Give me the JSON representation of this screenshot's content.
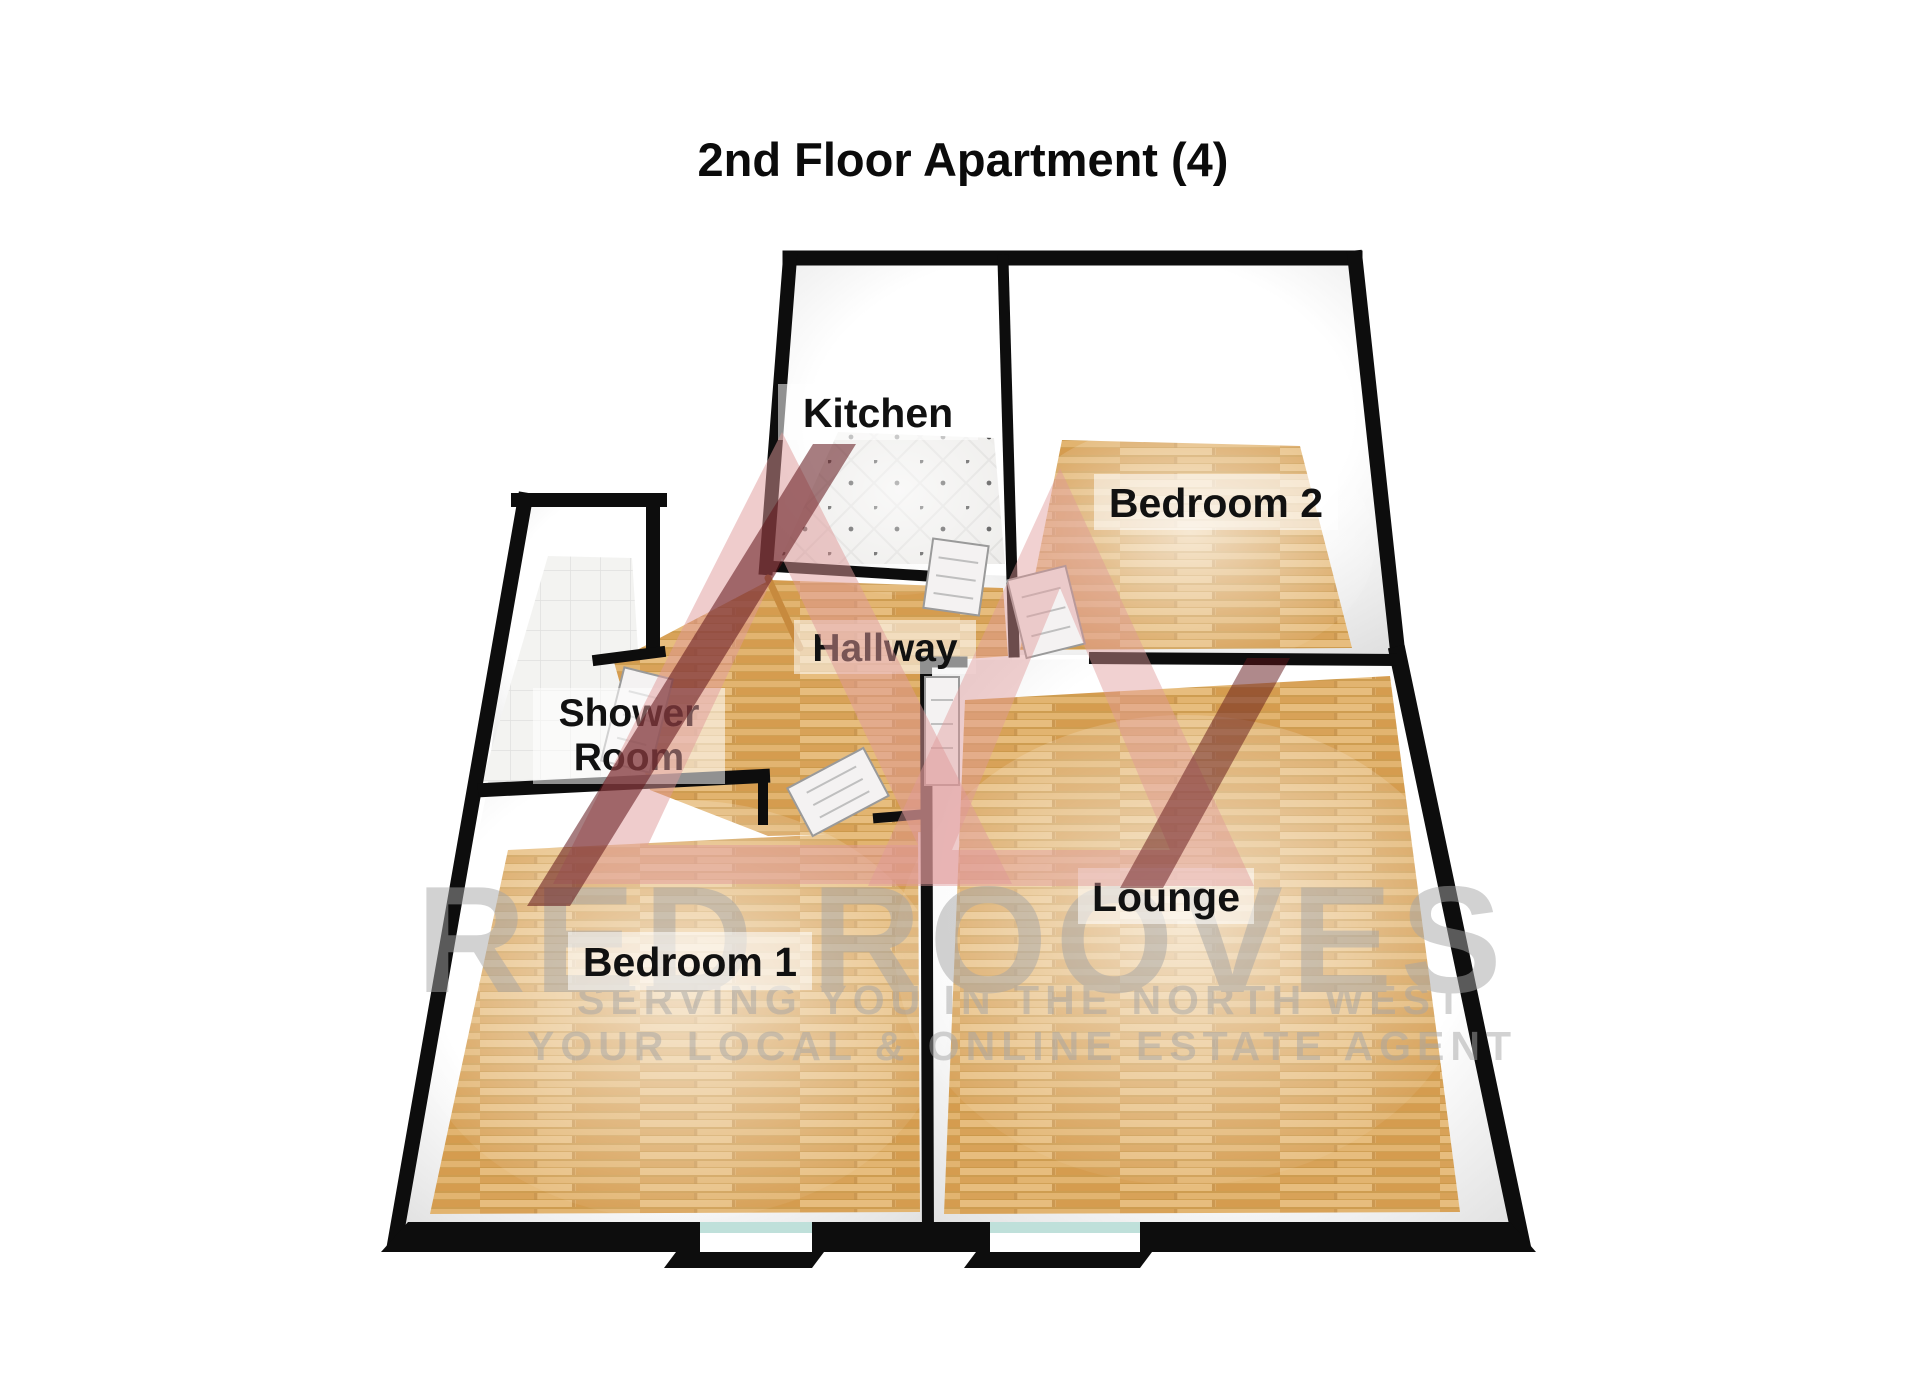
{
  "title": "2nd Floor Apartment (4)",
  "rooms": {
    "kitchen": {
      "label": "Kitchen"
    },
    "bedroom2": {
      "label": "Bedroom 2"
    },
    "hallway": {
      "label": "Hallway"
    },
    "shower": {
      "label_line1": "Shower",
      "label_line2": "Room"
    },
    "bedroom1": {
      "label": "Bedroom 1"
    },
    "lounge": {
      "label": "Lounge"
    }
  },
  "watermark": {
    "brand": "RED ROOVES",
    "tagline1": "SERVING YOU IN THE NORTH WEST",
    "tagline2": "YOUR LOCAL & ONLINE ESTATE AGENT"
  },
  "colors": {
    "wall": "#0d0d0d",
    "wood_floor": "#dcab66",
    "tile_floor": "#efeeec",
    "logo_pink": "#e09a9a",
    "logo_dark_red": "#5f1318",
    "window_glass": "#bfe0da",
    "watermark_gray": "#a6a6a6"
  }
}
